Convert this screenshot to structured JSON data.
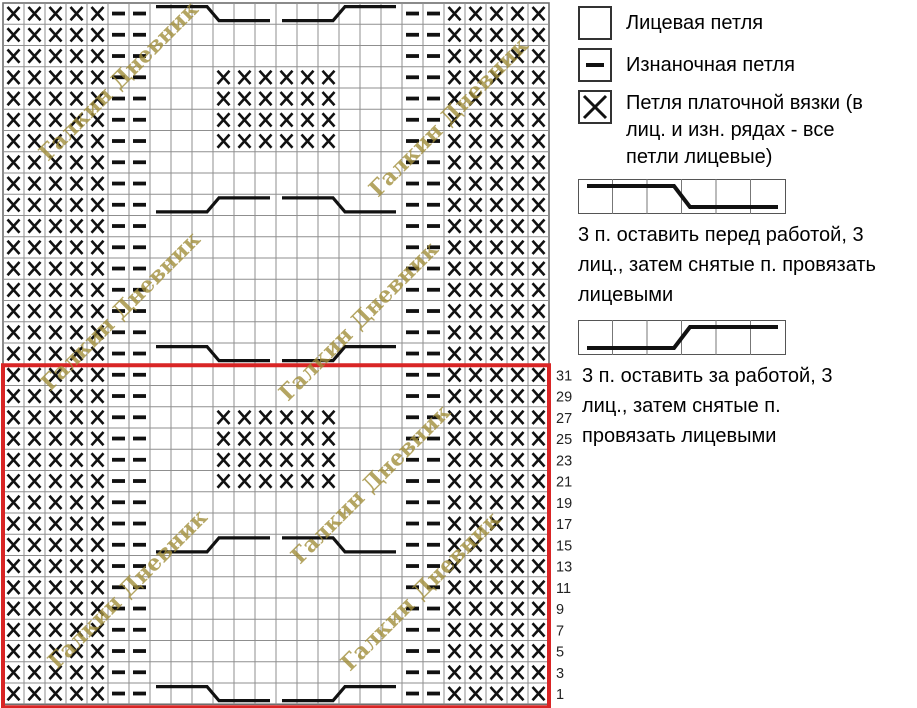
{
  "chart": {
    "columns": 26,
    "cell_symbols": {
      "K": "knit-empty",
      "P": "purl-dash",
      "G": "garter-x"
    },
    "rows": [
      {
        "label": "",
        "cells": "GGGGGPPKKKKKKKKKKKKPPGGGGG",
        "cables": [
          {
            "col": 8,
            "type": "front"
          },
          {
            "col": 14,
            "type": "back"
          }
        ]
      },
      {
        "label": "",
        "cells": "GGGGGPPKKKKKKKKKKKKPPGGGGG"
      },
      {
        "label": "",
        "cells": "GGGGGPPKKKKKKKKKKKKPPGGGGG"
      },
      {
        "label": "",
        "cells": "GGGGGPPKKKGGGGGGKKKPPGGGGG"
      },
      {
        "label": "",
        "cells": "GGGGGPPKKKGGGGGGKKKPPGGGGG"
      },
      {
        "label": "",
        "cells": "GGGGGPPKKKGGGGGGKKKPPGGGGG"
      },
      {
        "label": "",
        "cells": "GGGGGPPKKKGGGGGGKKKPPGGGGG"
      },
      {
        "label": "",
        "cells": "GGGGGPPKKKKKKKKKKKKPPGGGGG"
      },
      {
        "label": "",
        "cells": "GGGGGPPKKKKKKKKKKKKPPGGGGG"
      },
      {
        "label": "",
        "cells": "GGGGGPPKKKKKKKKKKKKPPGGGGG",
        "cables": [
          {
            "col": 8,
            "type": "back"
          },
          {
            "col": 14,
            "type": "front"
          }
        ]
      },
      {
        "label": "",
        "cells": "GGGGGPPKKKKKKKKKKKKPPGGGGG"
      },
      {
        "label": "",
        "cells": "GGGGGPPKKKKKKKKKKKKPPGGGGG"
      },
      {
        "label": "",
        "cells": "GGGGGPPKKKKKKKKKKKKPPGGGGG"
      },
      {
        "label": "",
        "cells": "GGGGGPPKKKKKKKKKKKKPPGGGGG"
      },
      {
        "label": "",
        "cells": "GGGGGPPKKKKKKKKKKKKPPGGGGG"
      },
      {
        "label": "",
        "cells": "GGGGGPPKKKKKKKKKKKKPPGGGGG"
      },
      {
        "label": "",
        "cells": "GGGGGPPKKKKKKKKKKKKPPGGGGG",
        "cables": [
          {
            "col": 8,
            "type": "front"
          },
          {
            "col": 14,
            "type": "back"
          }
        ]
      },
      {
        "label": "31",
        "cells": "GGGGGPPKKKKKKKKKKKKPPGGGGG"
      },
      {
        "label": "29",
        "cells": "GGGGGPPKKKKKKKKKKKKPPGGGGG"
      },
      {
        "label": "27",
        "cells": "GGGGGPPKKKGGGGGGKKKPPGGGGG"
      },
      {
        "label": "25",
        "cells": "GGGGGPPKKKGGGGGGKKKPPGGGGG"
      },
      {
        "label": "23",
        "cells": "GGGGGPPKKKGGGGGGKKKPPGGGGG"
      },
      {
        "label": "21",
        "cells": "GGGGGPPKKKGGGGGGKKKPPGGGGG"
      },
      {
        "label": "19",
        "cells": "GGGGGPPKKKKKKKKKKKKPPGGGGG"
      },
      {
        "label": "17",
        "cells": "GGGGGPPKKKKKKKKKKKKPPGGGGG"
      },
      {
        "label": "15",
        "cells": "GGGGGPPKKKKKKKKKKKKPPGGGGG",
        "cables": [
          {
            "col": 8,
            "type": "back"
          },
          {
            "col": 14,
            "type": "front"
          }
        ]
      },
      {
        "label": "13",
        "cells": "GGGGGPPKKKKKKKKKKKKPPGGGGG"
      },
      {
        "label": "11",
        "cells": "GGGGGPPKKKKKKKKKKKKPPGGGGG"
      },
      {
        "label": "9",
        "cells": "GGGGGPPKKKKKKKKKKKKPPGGGGG"
      },
      {
        "label": "7",
        "cells": "GGGGGPPKKKKKKKKKKKKPPGGGGG"
      },
      {
        "label": "5",
        "cells": "GGGGGPPKKKKKKKKKKKKPPGGGGG"
      },
      {
        "label": "3",
        "cells": "GGGGGPPKKKKKKKKKKKKPPGGGGG"
      },
      {
        "label": "1",
        "cells": "GGGGGPPKKKKKKKKKKKKPPGGGGG",
        "cables": [
          {
            "col": 8,
            "type": "front"
          },
          {
            "col": 14,
            "type": "back"
          }
        ]
      }
    ]
  },
  "repeat_frame": {
    "start_row_index": 18,
    "end_row_index": 33,
    "color": "#d92525"
  },
  "watermark": {
    "text": "Галкин Дневник",
    "color": "#a28f3c",
    "positions": [
      {
        "x": 48,
        "y": 162
      },
      {
        "x": 378,
        "y": 198
      },
      {
        "x": 50,
        "y": 392
      },
      {
        "x": 288,
        "y": 402
      },
      {
        "x": 300,
        "y": 565
      },
      {
        "x": 57,
        "y": 670
      },
      {
        "x": 350,
        "y": 672
      }
    ]
  },
  "legend": {
    "items": [
      {
        "symbol": "knit-square",
        "label": "Лицевая петля"
      },
      {
        "symbol": "purl-square",
        "label": "Изнаночная петля"
      },
      {
        "symbol": "garter-square",
        "label": "Петля платочной вязки (в лиц. и изн. рядах - все петли лицевые)"
      },
      {
        "symbol": "cable-front-strip",
        "label": "3 п. оставить перед работой, 3 лиц., затем снятые п. провязать лицевыми"
      },
      {
        "symbol": "cable-back-strip",
        "label": "3 п. оставить за работой, 3 лиц., затем снятые п. провязать лицевыми"
      }
    ]
  },
  "colors": {
    "grid_line": "#8f8f8f",
    "chart_border": "#6e6e6e",
    "symbol": "#111111"
  }
}
